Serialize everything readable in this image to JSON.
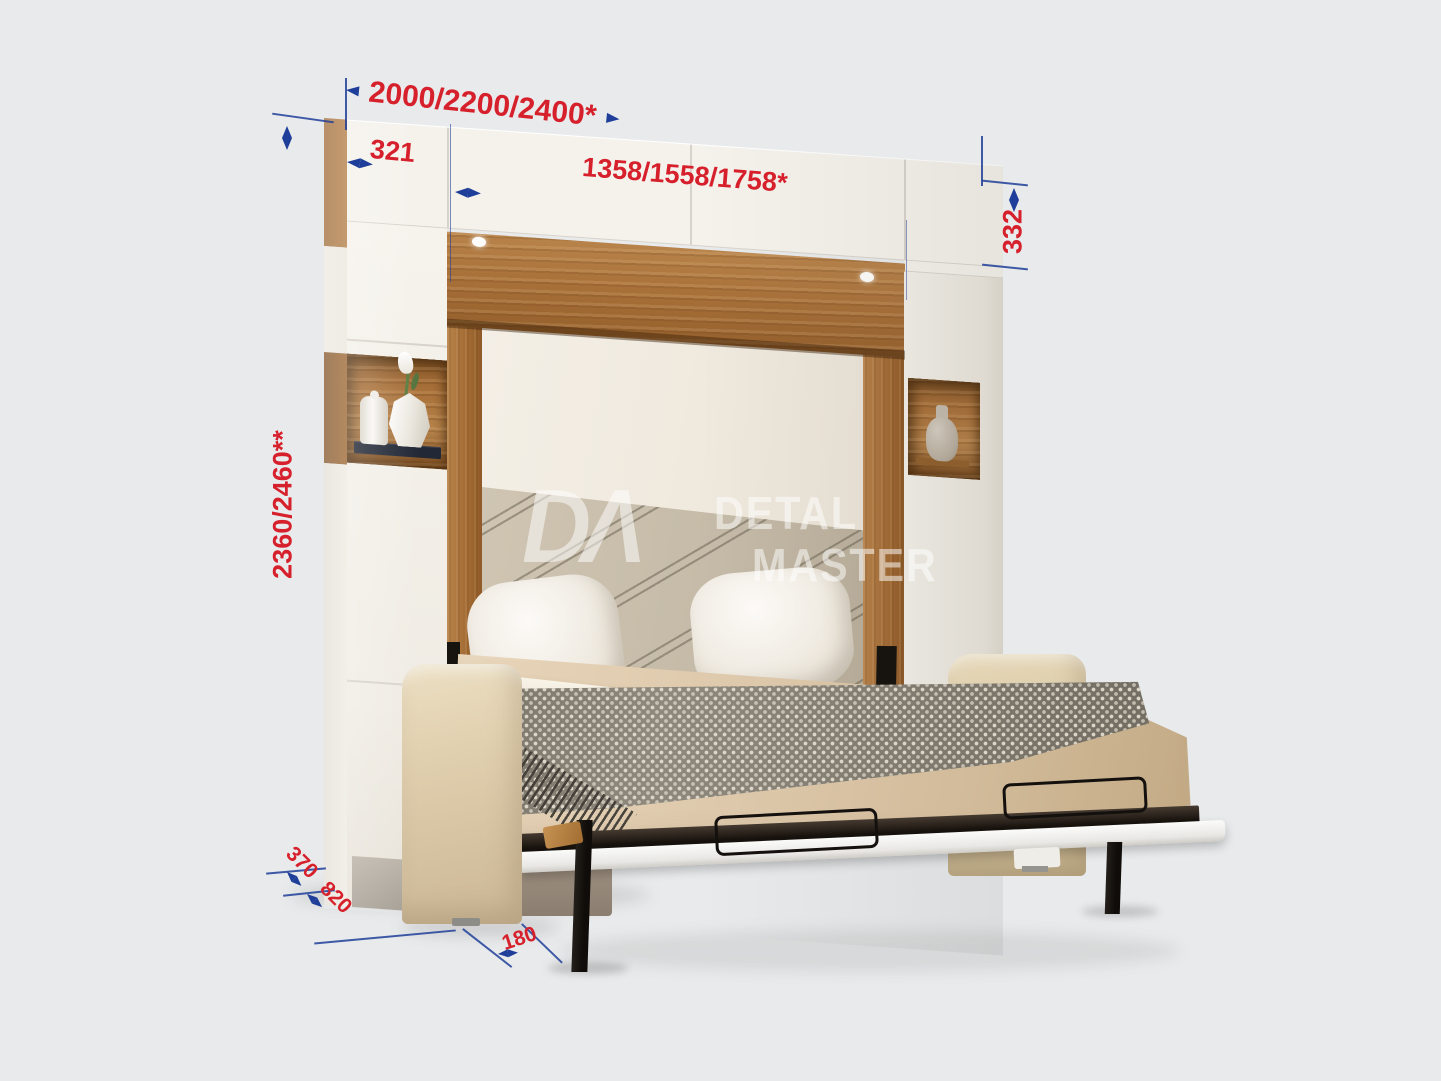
{
  "palette": {
    "bg": "#e8eaec",
    "red": "#d6202c",
    "blue": "#1e3e99",
    "wood": "#b07c45",
    "wood_dark": "#8a5a2e",
    "panel": "#f5f2ec",
    "seam": "#d8d3ca",
    "wall": "#f2ece2",
    "headboard": "#c9beac",
    "bedding": "#dcc7a9",
    "sheet": "#f6f0e4",
    "throw": "#8f897d",
    "throw_dot": "#e1dbcd",
    "sofa": "#ddcbaa",
    "sofa_base": "#a29482",
    "black": "#17130f",
    "platform": "#f2f1ee"
  },
  "dimensions": {
    "total_width": "2000/2200/2400*",
    "left_cabinet_width": "321",
    "bed_niche_width": "1358/1558/1758*",
    "top_cabinet_height": "332",
    "total_height": "2360/2460**",
    "cabinet_depth": "370",
    "sofa_depth": "820",
    "leg_offset": "180"
  },
  "watermark": {
    "monogram": "DΛ",
    "line1": "DETAL",
    "line2": "MASTER"
  }
}
